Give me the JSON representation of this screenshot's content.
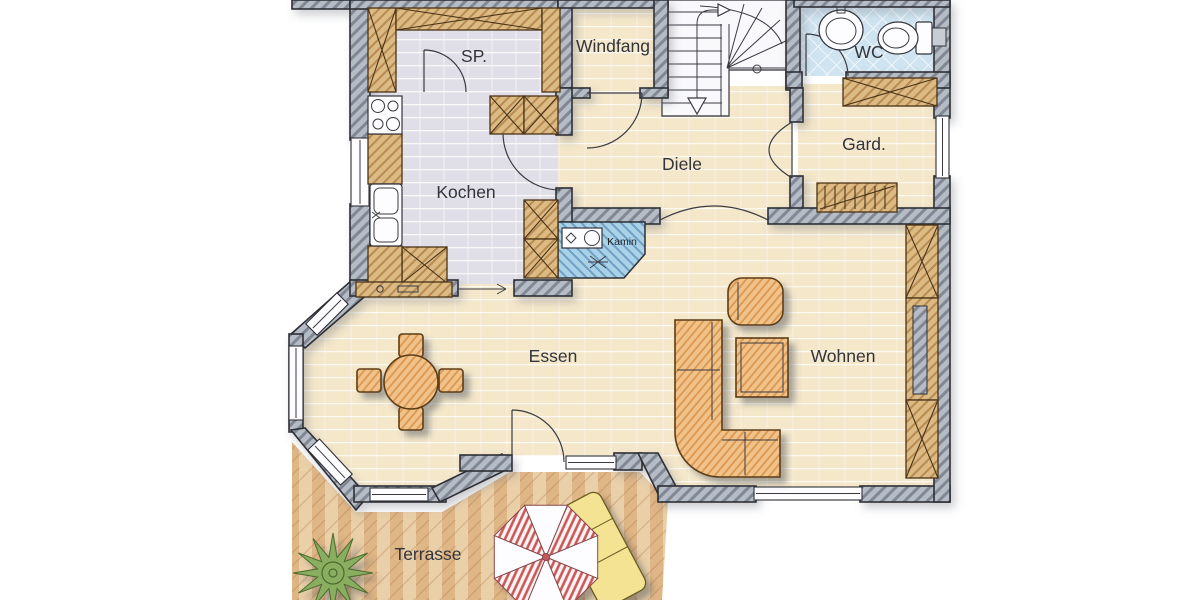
{
  "colors": {
    "wall": "#b6bcc6",
    "wood": "#dcba84",
    "furniture": "#f1c289",
    "floor_beige": "#f4e7ca",
    "floor_gray": "#e0dfe8",
    "floor_wc": "#cfe4f0",
    "kamin": "#a9d2e8",
    "terrace": "#ead0a8",
    "parasol": "#c9585a",
    "lounger": "#f3e392",
    "plant": "#8aae5e",
    "outline": "#2e2f36"
  },
  "rooms": {
    "sp": {
      "label": "SP."
    },
    "windfang": {
      "label": "Windfang"
    },
    "wc": {
      "label": "WC"
    },
    "kochen": {
      "label": "Kochen"
    },
    "diele": {
      "label": "Diele"
    },
    "gard": {
      "label": "Gard."
    },
    "kamin": {
      "label": "Kamin"
    },
    "essen": {
      "label": "Essen"
    },
    "wohnen": {
      "label": "Wohnen"
    },
    "terrasse": {
      "label": "Terrasse"
    }
  }
}
